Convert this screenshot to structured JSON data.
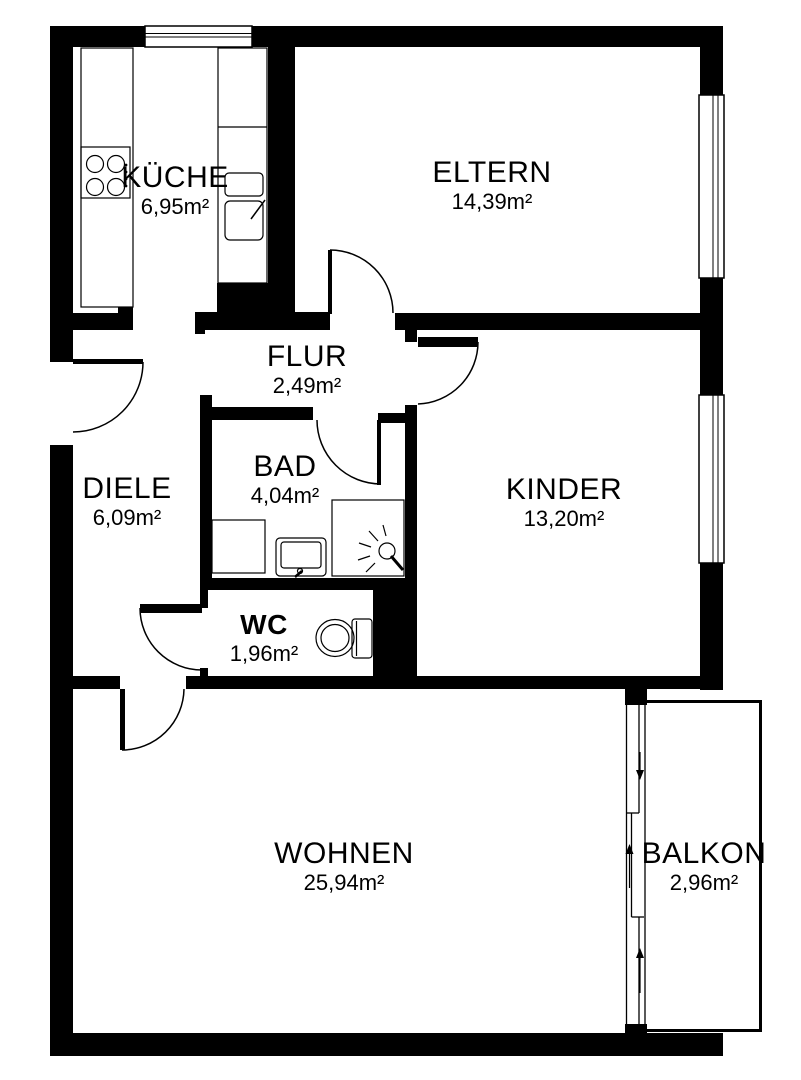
{
  "plan": {
    "rooms": {
      "kueche": {
        "name": "KÜCHE",
        "area": "6,95m²"
      },
      "eltern": {
        "name": "ELTERN",
        "area": "14,39m²"
      },
      "flur": {
        "name": "FLUR",
        "area": "2,49m²"
      },
      "bad": {
        "name": "BAD",
        "area": "4,04m²"
      },
      "diele": {
        "name": "DIELE",
        "area": "6,09m²"
      },
      "kinder": {
        "name": "KINDER",
        "area": "13,20m²"
      },
      "wc": {
        "name": "WC",
        "area": "1,96m²"
      },
      "wohnen": {
        "name": "WOHNEN",
        "area": "25,94m²"
      },
      "balkon": {
        "name": "BALKON",
        "area": "2,96m²"
      }
    },
    "colors": {
      "wall": "#000000",
      "background": "#ffffff",
      "line": "#000000",
      "text": "#000000"
    }
  }
}
